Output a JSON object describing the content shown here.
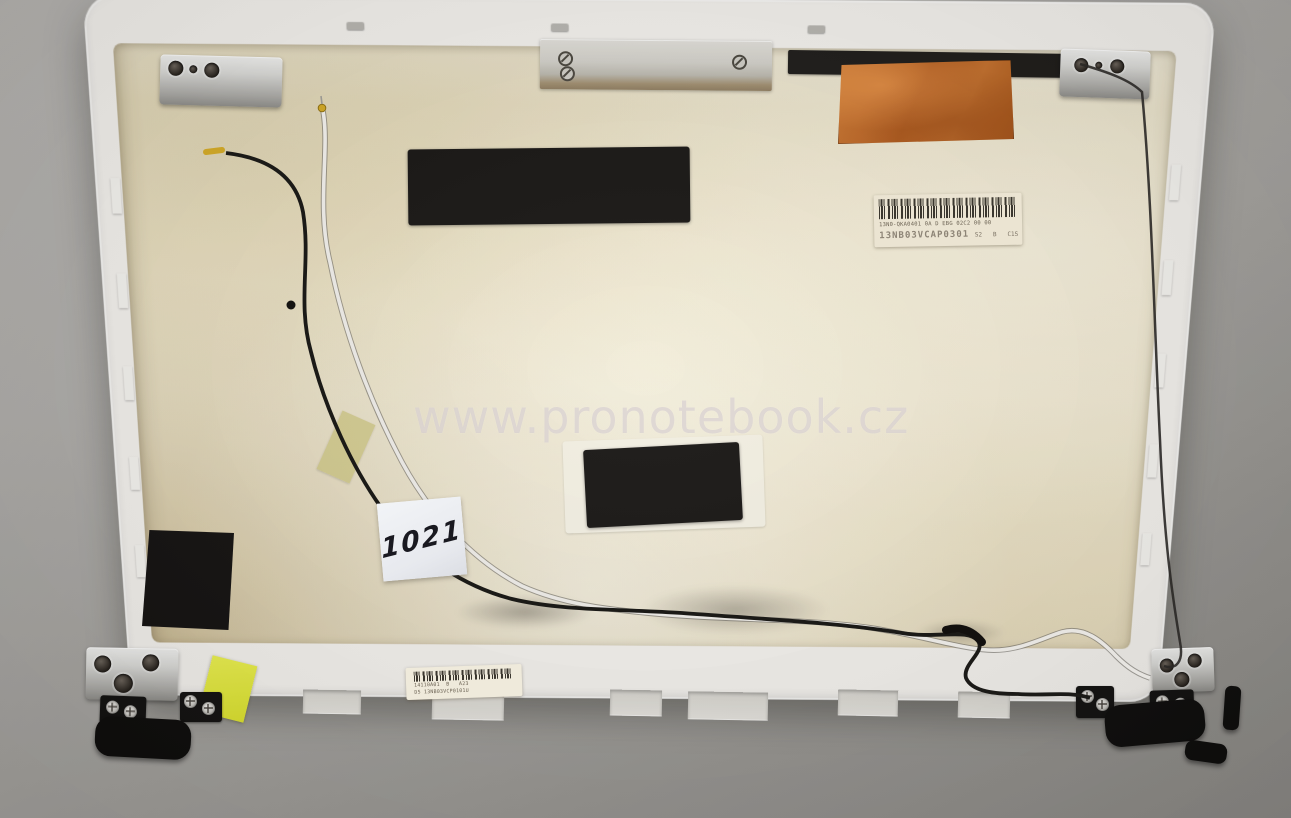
{
  "photo": {
    "subject": "White laptop LCD back cover (inner side) with WiFi antenna cables, lying on a grey desk",
    "watermark": "www.pronotebook.cz",
    "handwritten_note": "1021"
  },
  "labels": {
    "top_right": {
      "line1": "13N0-QKA0401 0A D EBG 02C2 00 00",
      "line2": "13NB03VCAP0301",
      "line2_suffix": "S2   B   C1S"
    },
    "bottom": {
      "line1": "14110A01  B   A23",
      "line2": "D5 13NB03VCP0101U"
    }
  },
  "colors": {
    "desk": "#a8a6a2",
    "shell_white": "#f3f1ed",
    "foil_beige": "#eae1c6",
    "copper_tape": "#c06a2a",
    "foam_pad_black": "#161412",
    "tape_yellow": "#e3ea3f",
    "sticky_note": "#eef0f4",
    "watermark_tint": "#cdc4c8"
  }
}
